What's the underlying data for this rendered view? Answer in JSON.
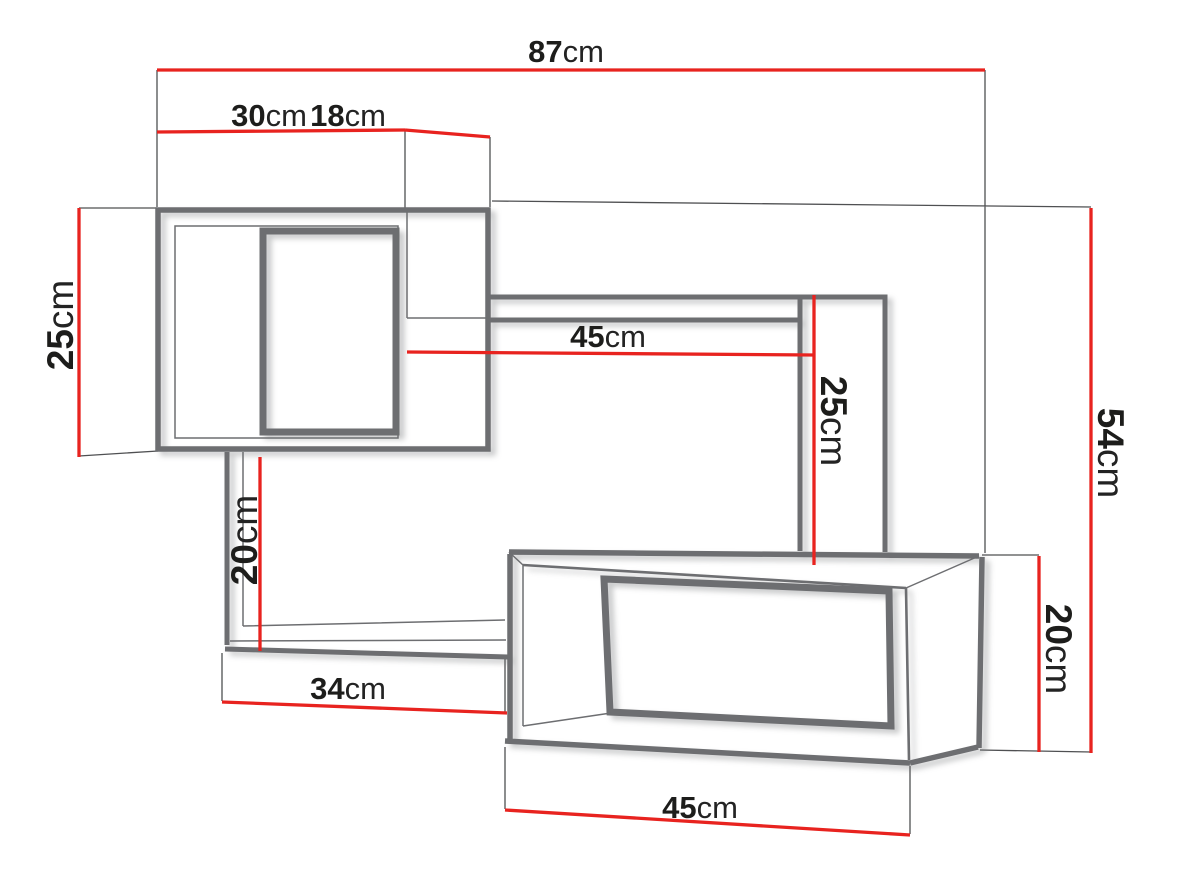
{
  "diagram": {
    "kind": "furniture dimension drawing",
    "subject": "wall shelf unit with three open compartments",
    "unit": "cm",
    "background": "#ffffff",
    "colors": {
      "dimension_line_red": "#e8231f",
      "outline_gray": "#6d6e71",
      "label_black": "#1d1d1b"
    },
    "dimensions": {
      "total_width": {
        "value": "87",
        "unit": "cm"
      },
      "top_box_width": {
        "value": "30",
        "unit": "cm"
      },
      "depth": {
        "value": "18",
        "unit": "cm"
      },
      "top_box_height": {
        "value": "25",
        "unit": "cm"
      },
      "middle_opening_width": {
        "value": "45",
        "unit": "cm"
      },
      "middle_opening_height": {
        "value": "25",
        "unit": "cm"
      },
      "left_connector_height": {
        "value": "20",
        "unit": "cm"
      },
      "lower_shelf_width": {
        "value": "34",
        "unit": "cm"
      },
      "total_height": {
        "value": "54",
        "unit": "cm"
      },
      "bottom_box_height": {
        "value": "20",
        "unit": "cm"
      },
      "bottom_box_width": {
        "value": "45",
        "unit": "cm"
      }
    }
  }
}
